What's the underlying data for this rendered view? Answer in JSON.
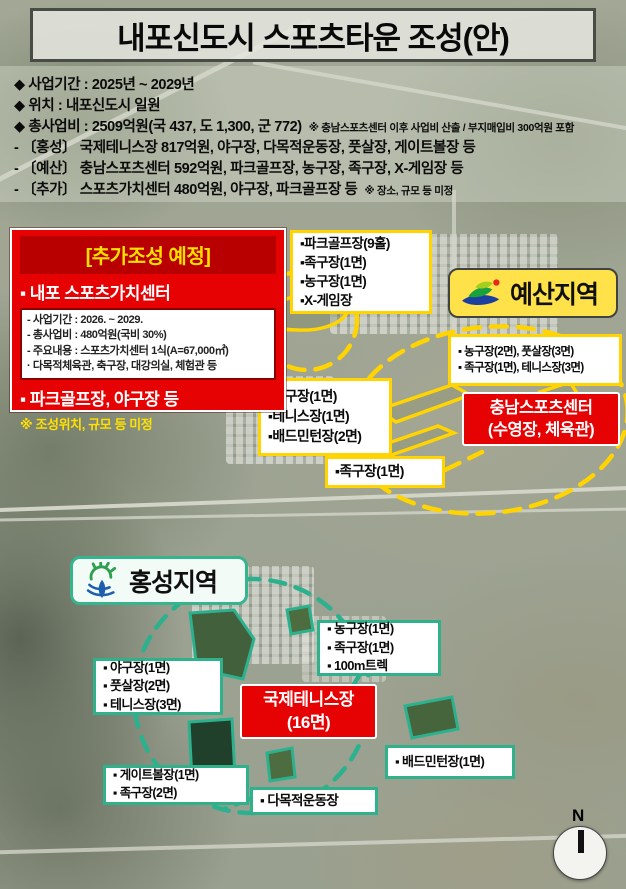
{
  "title": "내포신도시 스포츠타운 조성(안)",
  "info": {
    "items": [
      {
        "text": "◆ 사업기간 : 2025년 ~ 2029년"
      },
      {
        "text": "◆ 위치 : 내포신도시 일원"
      },
      {
        "text": "◆ 총사업비 : 2509억원(국 437, 도 1,300, 군 772)",
        "note": "※ 충남스포츠센터 이후 사업비 산출 / 부지매입비 300억원 포함"
      },
      {
        "text": "- 〔홍성〕 국제테니스장 817억원, 야구장, 다목적운동장, 풋살장, 게이트볼장 등"
      },
      {
        "text": "- 〔예산〕 충남스포츠센터 592억원, 파크골프장, 농구장, 족구장, X-게임장 등"
      },
      {
        "text": "- 〔추가〕 스포츠가치센터 480억원, 야구장, 파크골프장 등",
        "note": "※ 장소, 규모 등 미정"
      }
    ]
  },
  "plan_box": {
    "header": "[추가조성 예정]",
    "item1": "▪ 내포 스포츠가치센터",
    "details": [
      "- 사업기간 : 2026. ~ 2029.",
      "- 총사업비 : 480억원(국비 30%)",
      "- 주요내용 : 스포츠가치센터 1식(A=67,000㎡)",
      "· 다목적체육관, 축구장, 대강의실, 체험관 등"
    ],
    "item2": "▪ 파크골프장, 야구장 등",
    "footnote": "※ 조성위치, 규모 등 미정"
  },
  "regions": {
    "yesan": {
      "label": "예산지역"
    },
    "hongseong": {
      "label": "홍성지역"
    }
  },
  "map_labels": {
    "yesan_top": [
      "▪파크골프장(9홀)",
      "▪족구장(1면)",
      "▪농구장(1면)",
      "▪X-게임장"
    ],
    "yesan_right": [
      "▪ 농구장(2면), 풋살장(3면)",
      "▪ 족구장(1면), 테니스장(3면)"
    ],
    "chungnam_center": [
      "충남스포츠센터",
      "(수영장, 체육관)"
    ],
    "yesan_mid": [
      "▪농구장(1면)",
      "▪테니스장(1면)",
      "▪배드민턴장(2면)"
    ],
    "jokgu": "▪족구장(1면)",
    "hs_right": [
      "▪ 농구장(1면)",
      "▪ 족구장(1면)",
      "▪ 100m트렉"
    ],
    "tennis_center": [
      "국제테니스장",
      "(16면)"
    ],
    "hs_left": [
      "▪ 야구장(1면)",
      "▪ 풋살장(2면)",
      "▪ 테니스장(3면)"
    ],
    "gateball": [
      "▪ 게이트볼장(1면)",
      "▪ 족구장(2면)"
    ],
    "multi": "▪ 다목적운동장",
    "badminton": "▪ 배드민턴장(1면)"
  },
  "compass": {
    "label": "N"
  },
  "colors": {
    "accent_yellow": "#ffd400",
    "accent_red": "#e60202",
    "accent_teal": "#2fb28c",
    "badge_yellow": "#ffe14a"
  }
}
